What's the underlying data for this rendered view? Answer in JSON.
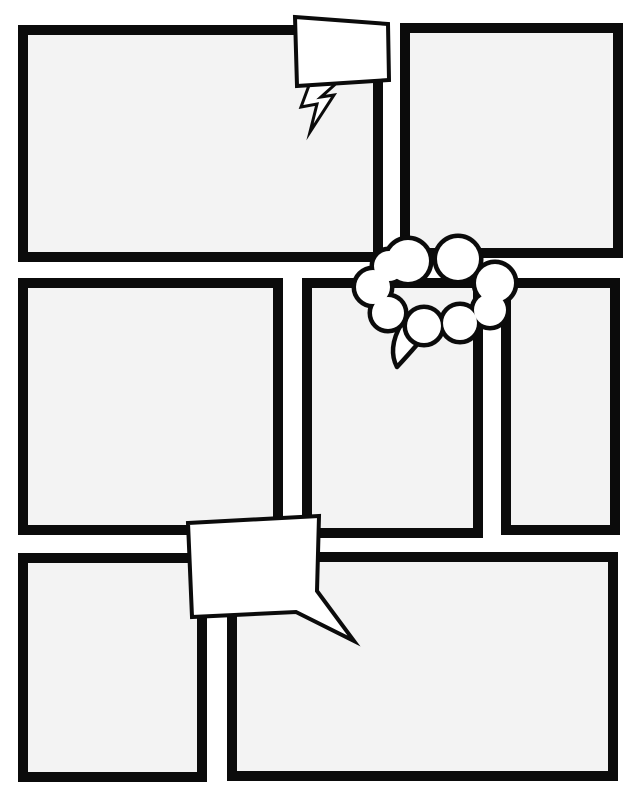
{
  "page": {
    "width": 640,
    "height": 800,
    "background": "#ffffff",
    "ink": "#0b0b0b",
    "panel_fill": "#f3f3f3",
    "bubble_fill": "#ffffff",
    "description": "Blank comic book page template with seven empty panels and three empty balloons"
  },
  "panels": [
    {
      "name": "panel-top-left",
      "x": 18,
      "y": 25,
      "w": 365,
      "h": 237
    },
    {
      "name": "panel-top-right",
      "x": 400,
      "y": 23,
      "w": 223,
      "h": 235
    },
    {
      "name": "panel-middle-left",
      "x": 18,
      "y": 278,
      "w": 265,
      "h": 257
    },
    {
      "name": "panel-middle-center",
      "x": 302,
      "y": 278,
      "w": 181,
      "h": 260
    },
    {
      "name": "panel-middle-right",
      "x": 501,
      "y": 278,
      "w": 119,
      "h": 257
    },
    {
      "name": "panel-bottom-left",
      "x": 18,
      "y": 553,
      "w": 189,
      "h": 229
    },
    {
      "name": "panel-bottom-right",
      "x": 227,
      "y": 552,
      "w": 391,
      "h": 229
    }
  ],
  "bubbles": {
    "speech_rect_top": {
      "name": "speech-balloon-top",
      "body_points": "295,17 388,24 389,80 297,86",
      "stroke_width": 4,
      "bolt": {
        "name": "lightning-tail-icon",
        "points": "311,80 340,80 321,97 334,95 310,132 317,104 301,107",
        "stroke_width": 3
      }
    },
    "thought_cloud": {
      "name": "thought-balloon-cloud",
      "outline_width": 9,
      "circles": [
        [
          408,
          261,
          21
        ],
        [
          458,
          259,
          21
        ],
        [
          495,
          283,
          19
        ],
        [
          490,
          310,
          16
        ],
        [
          460,
          323,
          17
        ],
        [
          424,
          326,
          17
        ],
        [
          388,
          313,
          16
        ],
        [
          373,
          287,
          17
        ],
        [
          389,
          266,
          15
        ]
      ],
      "tail": {
        "name": "cloud-tail-icon",
        "path": "M402,323 C391,341 391,356 397,367 C409,354 420,342 429,330 Z",
        "stroke_width": 4.5
      }
    },
    "speech_rect_bottom": {
      "name": "speech-balloon-bottom",
      "points": "188,523 319,516 317,591 354,641 296,612 192,617",
      "stroke_width": 4
    }
  }
}
